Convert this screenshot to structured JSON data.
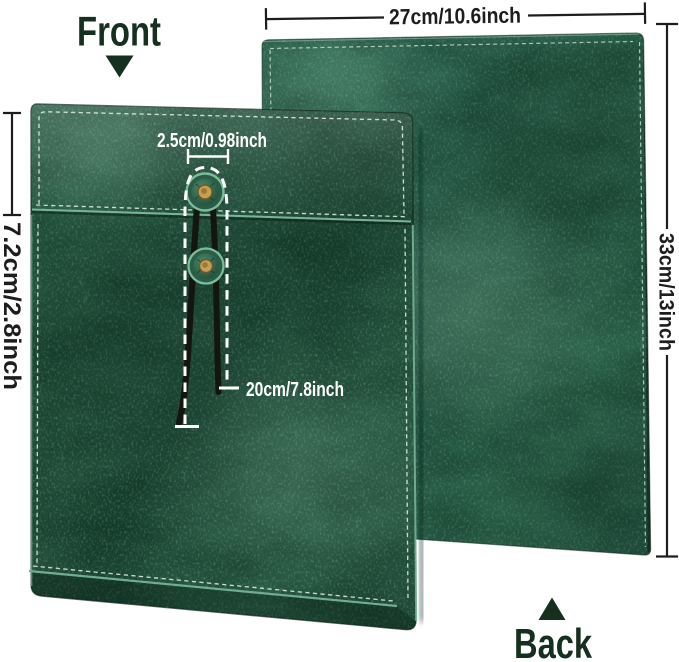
{
  "labels": {
    "front": "Front",
    "back": "Back"
  },
  "dimensions": {
    "width": "27cm/10.6inch",
    "height": "33cm/13inch",
    "flap": "7.2cm/2.8inch",
    "button": "2.5cm/0.98inch",
    "string": "20cm/7.8inch"
  },
  "colors": {
    "background": "#ffffff",
    "leather_front": "#275741",
    "leather_back": "#2d6450",
    "leather_highlight": "#8fc3a8",
    "edge_piping": "#6fae91",
    "stitching": "#e6f2e9",
    "brass_rivet": "#c79f52",
    "cord": "#15150f",
    "label_text": "#16301f",
    "dimension_text": "#1d1d1b",
    "annotation_text": "#ffffff"
  }
}
